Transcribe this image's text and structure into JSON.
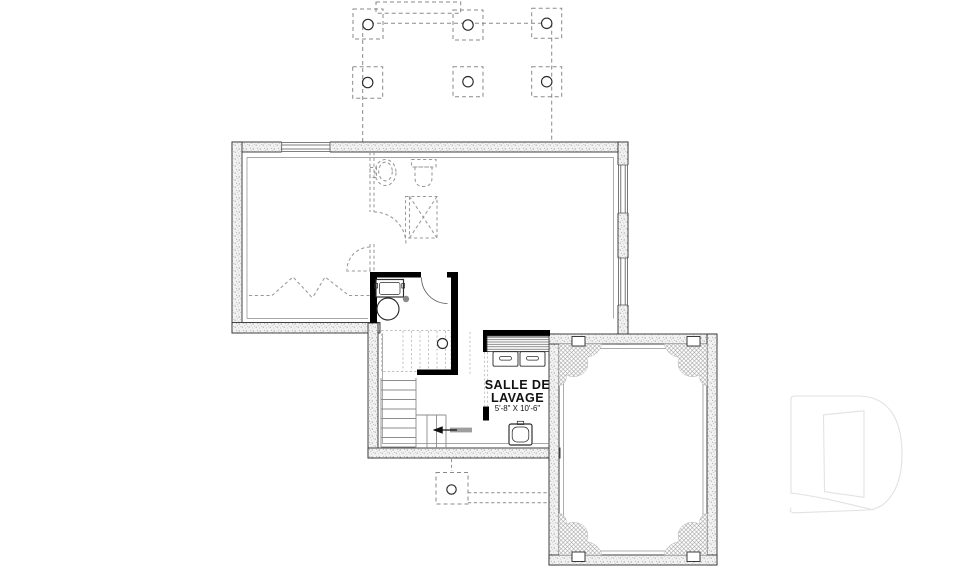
{
  "plan": {
    "rooms": [
      {
        "name_line1": "SALLE DE",
        "name_line2": "LAVAGE",
        "dimensions": "5'-8\" X 10'-6\""
      }
    ]
  },
  "colors": {
    "background": "#ffffff",
    "wall_stroke": "#2f2f2f",
    "partition_black": "#000000",
    "future_dashed_gray": "#999999",
    "light_dashed_gray": "#bdbdbd",
    "stair_gray": "#8c8c8c",
    "text_color": "#111111",
    "watermark_gray": "#e2e2e2"
  },
  "watermark": {
    "glyph": "D"
  }
}
